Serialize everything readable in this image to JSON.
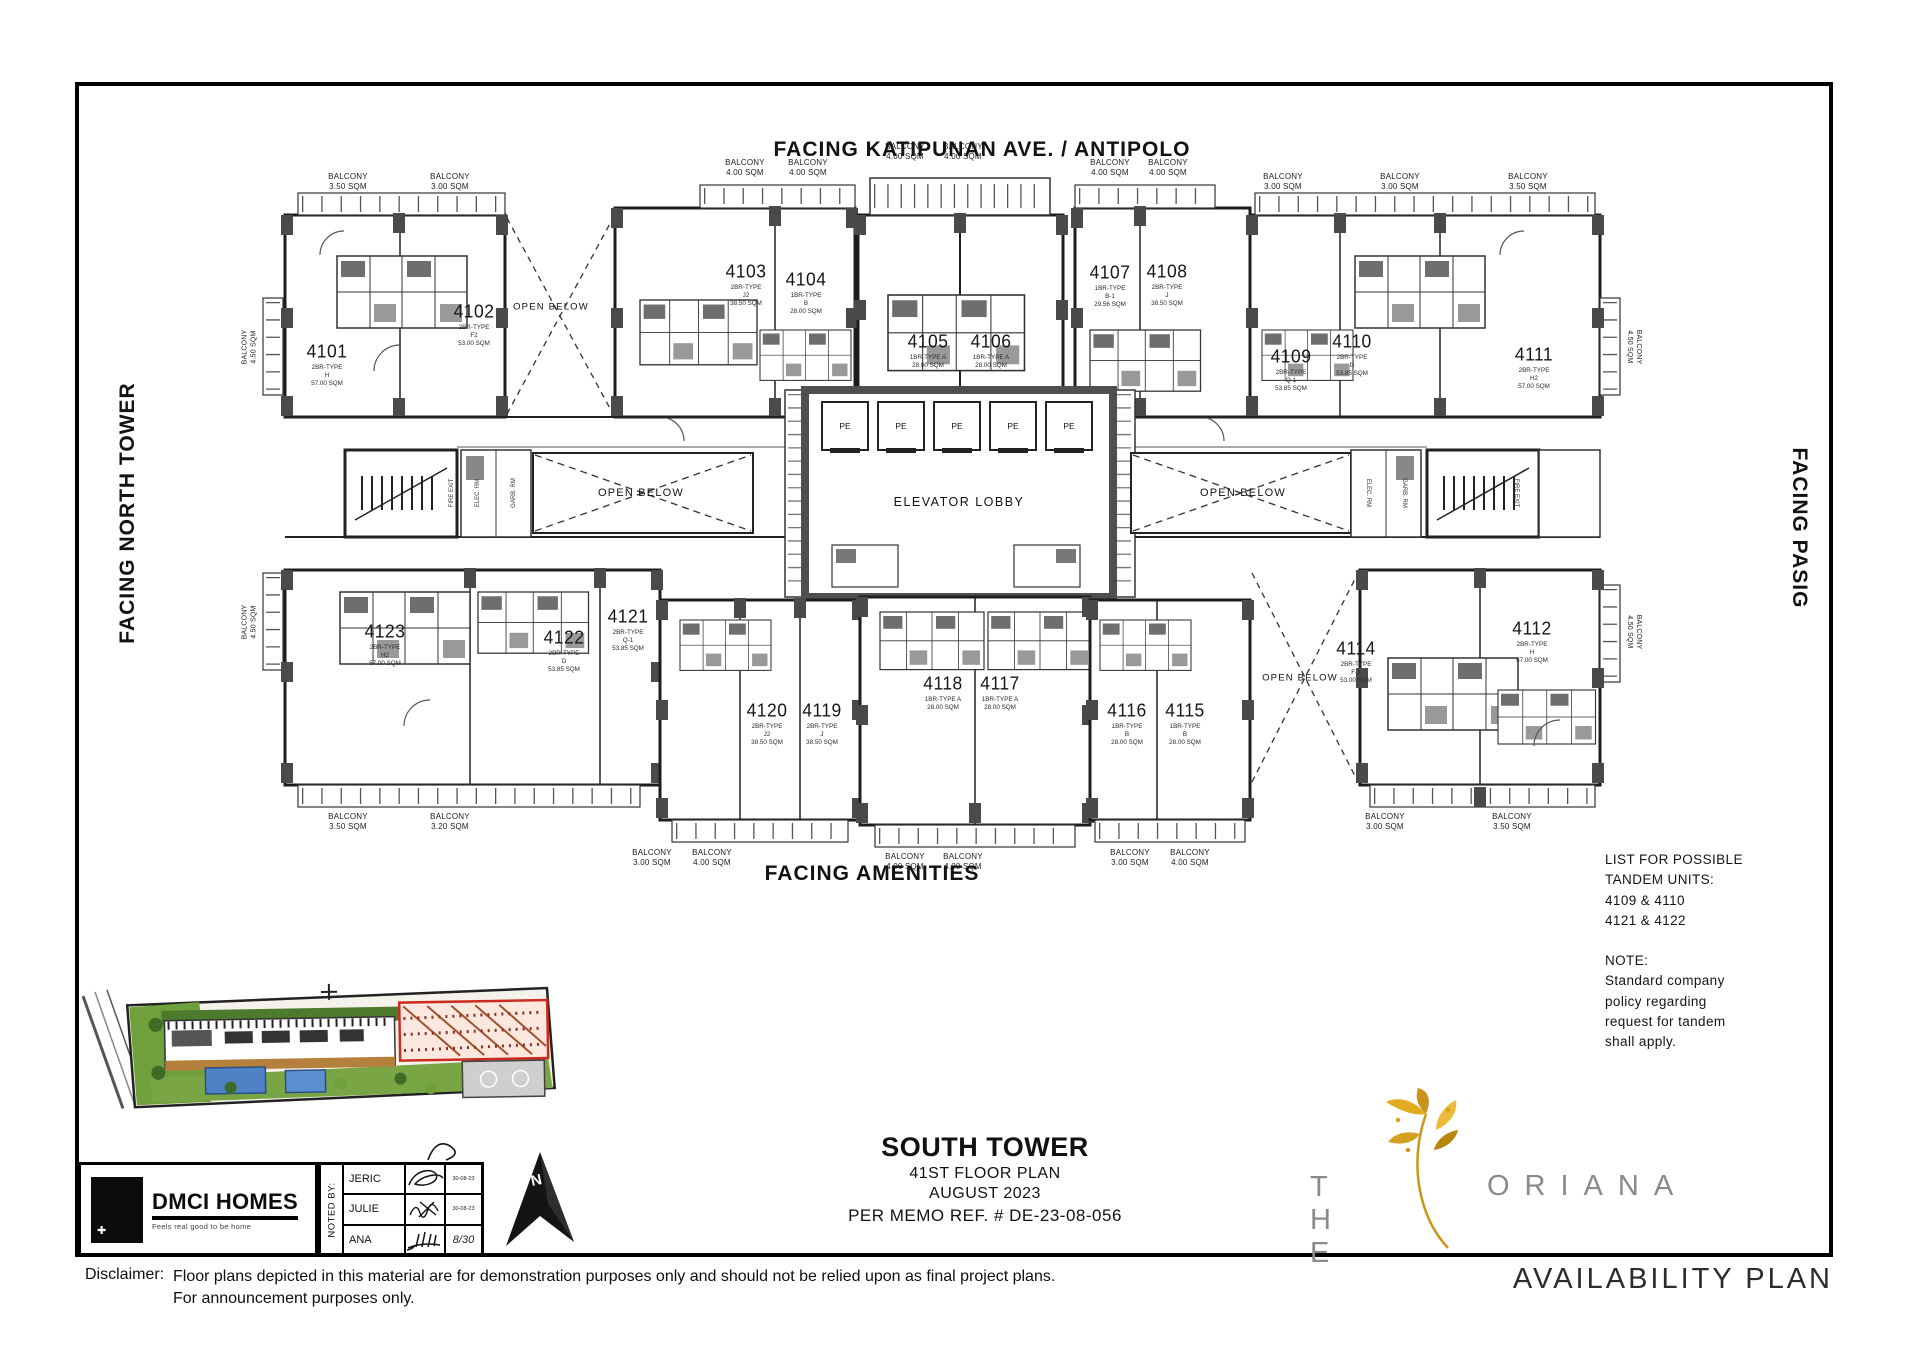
{
  "facing": {
    "top": "FACING KATIPUNAN AVE. / ANTIPOLO",
    "left": "FACING NORTH TOWER",
    "right": "FACING PASIG",
    "bottom": "FACING AMENITIES"
  },
  "plan": {
    "elevator_lobby_label": "ELEVATOR LOBBY",
    "elevator_car_label": "PE",
    "open_below_label": "OPEN BELOW",
    "fire_exit_label": "FIRE EXIT",
    "elec_label": "ELEC. RM",
    "garb_label": "GARB. RM",
    "units": [
      {
        "number": "4101",
        "sub": "2BR-TYPE\nH\n57.00 SQM"
      },
      {
        "number": "4102",
        "sub": "2BR-TYPE\nF2\n53.00 SQM"
      },
      {
        "number": "4103",
        "sub": "2BR-TYPE\nJ2\n38.50 SQM"
      },
      {
        "number": "4104",
        "sub": "1BR-TYPE\nB\n28.00 SQM"
      },
      {
        "number": "4105",
        "sub": "1BR-TYPE A\n28.00 SQM"
      },
      {
        "number": "4106",
        "sub": "1BR-TYPE A\n28.00 SQM"
      },
      {
        "number": "4107",
        "sub": "1BR-TYPE\nB-1\n29.56 SQM"
      },
      {
        "number": "4108",
        "sub": "2BR-TYPE\nJ\n38.50 SQM"
      },
      {
        "number": "4109",
        "sub": "2BR-TYPE\nQ-1\n53.85 SQM"
      },
      {
        "number": "4110",
        "sub": "2BR-TYPE\nD\n53.85 SQM"
      },
      {
        "number": "4111",
        "sub": "2BR-TYPE\nH2\n57.00 SQM"
      },
      {
        "number": "4112",
        "sub": "2BR-TYPE\nH\n57.00 SQM"
      },
      {
        "number": "4114",
        "sub": "2BR-TYPE\nF-1\n53.00 SQM"
      },
      {
        "number": "4115",
        "sub": "1BR-TYPE\nB\n28.00 SQM"
      },
      {
        "number": "4116",
        "sub": "1BR-TYPE\nB\n28.00 SQM"
      },
      {
        "number": "4117",
        "sub": "1BR-TYPE A\n28.00 SQM"
      },
      {
        "number": "4118",
        "sub": "1BR-TYPE A\n28.00 SQM"
      },
      {
        "number": "4119",
        "sub": "2BR-TYPE\nJ\n38.50 SQM"
      },
      {
        "number": "4120",
        "sub": "2BR-TYPE\nJ2\n38.50 SQM"
      },
      {
        "number": "4121",
        "sub": "2BR-TYPE\nQ-1\n53.85 SQM"
      },
      {
        "number": "4122",
        "sub": "2BR-TYPE\nD\n53.85 SQM"
      },
      {
        "number": "4123",
        "sub": "2BR-TYPE\nH2\n57.00 SQM"
      }
    ],
    "balconies_top": [
      {
        "label": "BALCONY\n3.50 SQM"
      },
      {
        "label": "BALCONY\n3.00 SQM"
      },
      {
        "label": "BALCONY\n4.00 SQM"
      },
      {
        "label": "BALCONY\n4.00 SQM"
      },
      {
        "label": "BALCONY\n4.00 SQM"
      },
      {
        "label": "BALCONY\n4.00 SQM"
      },
      {
        "label": "BALCONY\n4.00 SQM"
      },
      {
        "label": "BALCONY\n4.00 SQM"
      },
      {
        "label": "BALCONY\n3.00 SQM"
      },
      {
        "label": "BALCONY\n3.00 SQM"
      },
      {
        "label": "BALCONY\n3.50 SQM"
      }
    ],
    "balconies_bottom": [
      {
        "label": "BALCONY\n3.50 SQM"
      },
      {
        "label": "BALCONY\n3.20 SQM"
      },
      {
        "label": "BALCONY\n3.00 SQM"
      },
      {
        "label": "BALCONY\n4.00 SQM"
      },
      {
        "label": "BALCONY\n4.00 SQM"
      },
      {
        "label": "BALCONY\n4.00 SQM"
      },
      {
        "label": "BALCONY\n3.00 SQM"
      },
      {
        "label": "BALCONY\n4.00 SQM"
      },
      {
        "label": "BALCONY\n3.00 SQM"
      },
      {
        "label": "BALCONY\n3.50 SQM"
      }
    ],
    "balconies_side": [
      {
        "label": "BALCONY\n4.50 SQM"
      },
      {
        "label": "BALCONY\n4.50 SQM"
      },
      {
        "label": "BALCONY\n4.50 SQM"
      },
      {
        "label": "BALCONY\n4.50 SQM"
      }
    ]
  },
  "tandem_note": {
    "title": "LIST FOR POSSIBLE\nTANDEM UNITS:",
    "pair1": "4109 & 4110",
    "pair2": "4121 & 4122",
    "note": "NOTE:\nStandard company\npolicy regarding\nrequest for tandem\nshall apply."
  },
  "title_block": {
    "tower": "SOUTH TOWER",
    "floor": "41ST FLOOR PLAN",
    "date": "AUGUST 2023",
    "memo": "PER MEMO REF. # DE-23-08-056"
  },
  "branding": {
    "dmci_name": "DMCI HOMES",
    "dmci_tagline": "Feels real good to be home",
    "dmci_icon_glyph": "✚",
    "the": "T H E",
    "oriana": "ORIANA",
    "availability": "AVAILABILITY PLAN",
    "north_letter": "N",
    "gold": "#D9A21F",
    "gray": "#8A8A8A"
  },
  "noted_by": {
    "label": "NOTED BY:",
    "rows": [
      {
        "name": "JERIC",
        "date": "30-08-23"
      },
      {
        "name": "JULIE",
        "date": "30-08-23"
      },
      {
        "name": "ANA",
        "date": "8/30"
      }
    ]
  },
  "disclaimer": {
    "label": "Disclaimer:",
    "body": "Floor plans depicted in this material are for demonstration purposes only and should not be relied upon as final project plans.\nFor announcement purposes only."
  }
}
